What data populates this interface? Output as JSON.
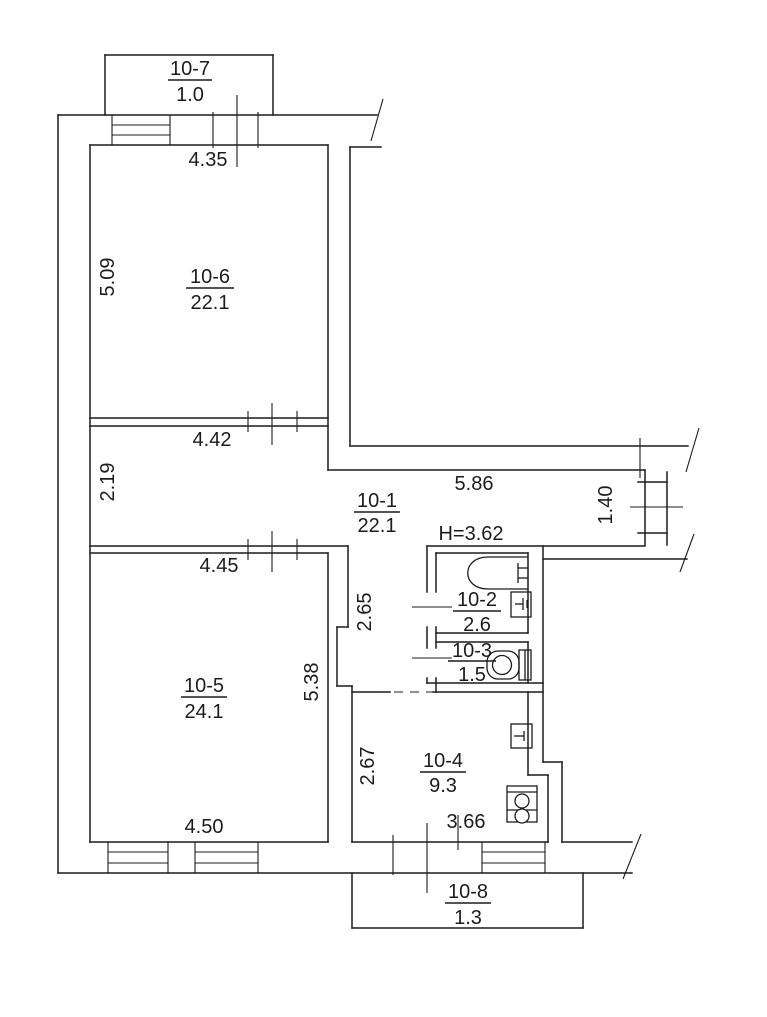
{
  "plan": {
    "rooms": {
      "hall": {
        "number": "10-1",
        "area": "22.1"
      },
      "bath": {
        "number": "10-2",
        "area": "2.6"
      },
      "wc": {
        "number": "10-3",
        "area": "1.5"
      },
      "kitchen": {
        "number": "10-4",
        "area": "9.3"
      },
      "living": {
        "number": "10-5",
        "area": "24.1"
      },
      "bedroom": {
        "number": "10-6",
        "area": "22.1"
      },
      "balcony_top": {
        "number": "10-7",
        "area": "1.0"
      },
      "balcony_bottom": {
        "number": "10-8",
        "area": "1.3"
      }
    },
    "dimensions": {
      "bedroom_width": "4.35",
      "bedroom_depth": "5.09",
      "hall_width": "4.42",
      "hall_depth": "2.19",
      "hall_arm_length": "5.86",
      "hall_arm_width": "1.40",
      "living_width_top": "4.45",
      "living_depth": "5.38",
      "living_width_bottom": "4.50",
      "nook_depth": "2.65",
      "kitchen_depth": "2.67",
      "kitchen_width": "3.66"
    },
    "notes": {
      "ceiling_height": "H=3.62"
    },
    "colors": {
      "line": "#1c1c1c",
      "note_blue": "#2424bb",
      "background": "#ffffff"
    }
  }
}
